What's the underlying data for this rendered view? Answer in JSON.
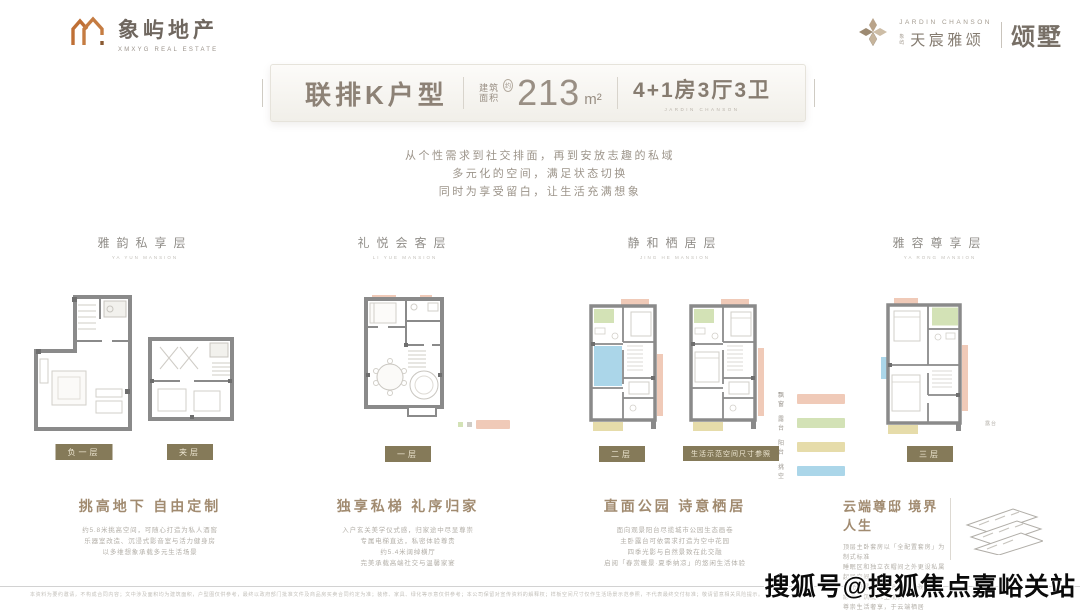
{
  "header": {
    "left_logo": {
      "name": "象屿地产",
      "tagline": "XMXYG REAL ESTATE"
    },
    "right_logo": {
      "brand_en": "JARDIN CHANSON",
      "brand_prefix": "象屿",
      "brand_cn": "天宸雅颂",
      "product": "颂墅"
    }
  },
  "title_bar": {
    "unit_name": "联排K户型",
    "area_label_line1": "建筑",
    "area_label_line2": "面积",
    "area_approx": "约",
    "area_value": "213",
    "area_unit": "m²",
    "layout": "4+1房3厅3卫",
    "layout_sub": "JARDIN CHANSON"
  },
  "tagline": {
    "line1": "从个性需求到社交排面，再到安放志趣的私域",
    "line2": "多元化的空间，满足状态切换",
    "line3": "同时为享受留白，让生活充满想象"
  },
  "columns": [
    {
      "title": "雅韵私享层",
      "subtitle": "YA YUN MANSION",
      "badges": [
        "负一层",
        "夹层"
      ],
      "heading": "挑高地下 自由定制",
      "body": [
        "约5.8米挑高空间，可随心打造为私人酒窖",
        "乐器室改造、沉浸式影音室与活力健身房",
        "以多维想象承载多元生活场景"
      ]
    },
    {
      "title": "礼悦会客层",
      "subtitle": "LI YUE MANSION",
      "badges": [
        "一层"
      ],
      "heading": "独享私梯 礼序归家",
      "body": [
        "入户玄关美学仪式感，归家途中尽显尊崇",
        "专属电梯直达，私密体验尊贵",
        "约5.4米阔绰横厅",
        "完美承载高端社交与温馨家宴"
      ]
    },
    {
      "title": "静和栖居层",
      "subtitle": "JING HE MANSION",
      "badges": [
        "二层",
        "生活示范空间尺寸参照"
      ],
      "heading": "直面公园 诗意栖居",
      "body": [
        "面向观景阳台尽揽城市公园生态画卷",
        "主卧露台可依需求打造为空中花园",
        "四季光影与自然景致在此交融",
        "启阅「春赏暖景·夏季纳凉」的悠闲生活体验"
      ]
    },
    {
      "title": "雅容尊享层",
      "subtitle": "YA RONG MANSION",
      "badges": [
        "三层"
      ],
      "heading": "云端尊邸 境界人生",
      "body": [
        "顶层主卧套房以「全配置套房」为制式标准",
        "睡眠区和独立衣帽间之外更设私属起居空间",
        "南北双露台尽享城市环伺视野",
        "静谧中沉淀人生境界",
        "尊崇生活奢享，于云端栖居"
      ]
    }
  ],
  "legend": {
    "items": [
      {
        "label": "飘窗",
        "color": "#f0cab8"
      },
      {
        "label": "露台",
        "color": "#d3e2b6"
      },
      {
        "label": "阳台",
        "color": "#e6dcaa"
      },
      {
        "label": "挑空",
        "color": "#abd6e9"
      }
    ]
  },
  "plan_labels": {
    "terrace": "露台"
  },
  "watermark": "搜狐号@搜狐焦点嘉峪关站",
  "disclaimer": "本资料为要约邀请，不构成合同内容；文中涉及面积均为建筑面积，户型图仅供参考，最终以政府部门批准文件及商品房买卖合同约定为准；装修、家具、绿化等示意仅供参考；本公司保留对宣传资料的解释权；样板空间尺寸仅作生活场景示范参照，不代表最终交付标准；敬请留意相关风险提示。"
}
